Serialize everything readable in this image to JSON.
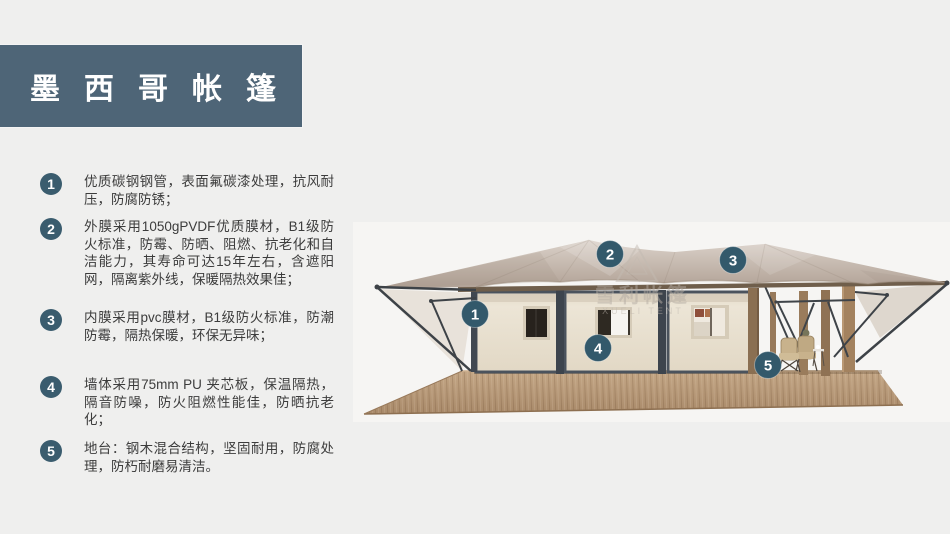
{
  "slide_title": {
    "text": "墨西哥帐篷"
  },
  "features": [
    {
      "num": "1",
      "text": "优质碳钢钢管，表面氟碳漆处理，抗风耐压，防腐防锈；"
    },
    {
      "num": "2",
      "text": "外膜采用1050gPVDF优质膜材，B1级防火标准，防霉、防晒、阻燃、抗老化和自洁能力，其寿命可达15年左右，含遮阳网，隔离紫外线，保暖隔热效果佳；"
    },
    {
      "num": "3",
      "text": "内膜采用pvc膜材，B1级防火标准，防潮防霉，隔热保暖，环保无异味；"
    },
    {
      "num": "4",
      "text": "墙体采用75mm PU 夹芯板，保温隔热，隔音防噪，防火阻燃性能佳，防晒抗老化；"
    },
    {
      "num": "5",
      "text": "地台：钢木混合结构，坚固耐用，防腐处理，防朽耐磨易清洁。"
    }
  ],
  "illustration": {
    "callouts": [
      {
        "num": "1"
      },
      {
        "num": "2"
      },
      {
        "num": "3"
      },
      {
        "num": "4"
      },
      {
        "num": "5"
      }
    ],
    "watermark": {
      "cn": "雪利帐篷",
      "en": "XUELI TENT"
    }
  },
  "colors": {
    "background": "#efefee",
    "title_bar": "#4e6577",
    "badge": "#3a5c6e",
    "canopy": "#c9bcb2",
    "wall": "#eae2d3",
    "deck_wood": "#b69879",
    "body_text": "#3c3c3c"
  }
}
